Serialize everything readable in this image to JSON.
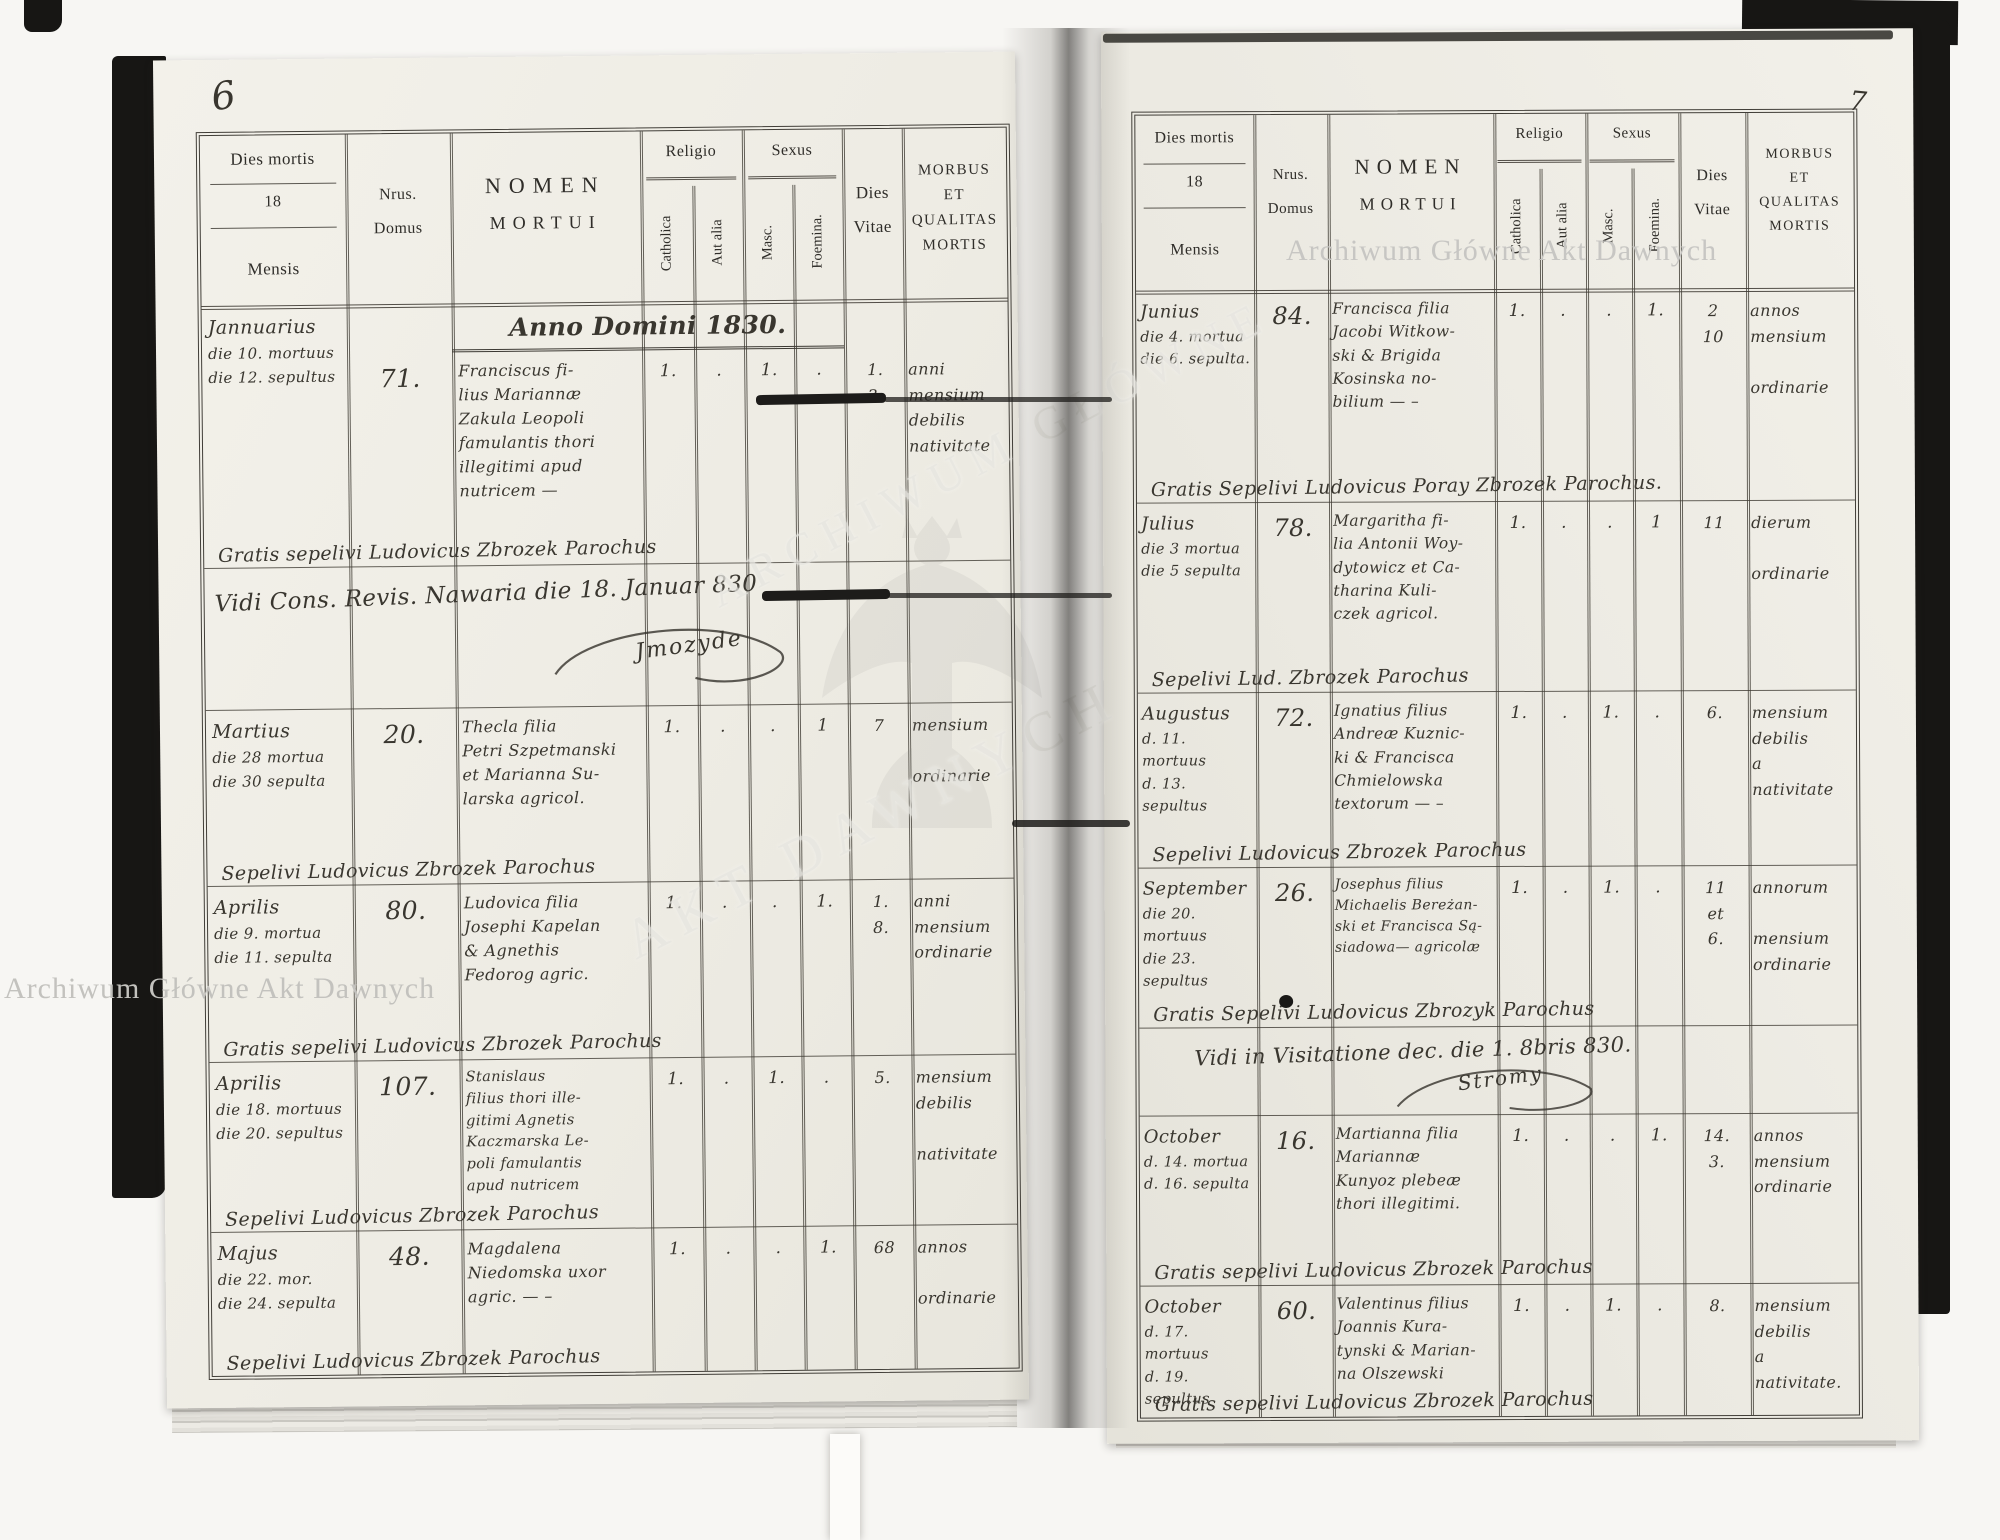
{
  "watermarks": {
    "archive_top": "Archiwum Główne Akt Dawnych",
    "archive_bottom": "Archiwum Główne Akt Dawnych",
    "ghost_line1": "ARCHIWUM GŁÓWNE",
    "ghost_line2": "AKT DAWNYCH"
  },
  "header": {
    "dies_mortis": "Dies mortis",
    "year_prefix": "18",
    "mensis": "Mensis",
    "nrus": "Nrus.",
    "domus": "Domus",
    "nomen": "NOMEN",
    "mortui": "MORTUI",
    "religio": "Religio",
    "catholica": "Catholica",
    "aut_alia": "Aut alia",
    "sexus": "Sexus",
    "masc": "Masc.",
    "foemina": "Foemina.",
    "dies": "Dies",
    "vitae": "Vitae",
    "morbus": "MORBUS",
    "et": "ET",
    "qualitas": "QUALITAS",
    "mortis": "MORTIS"
  },
  "pages": {
    "left": {
      "number": "6",
      "anno_line": "Anno Domini 1830.",
      "visitation": {
        "line": "Vidi Cons. Revis. Nawaria die 18. Januar 830",
        "signature": "Jmozyde"
      },
      "rows": [
        {
          "date": "Jannuarius\ndie 10. mortuus\ndie 12. sepultus",
          "house": "71.",
          "name": "Franciscus fi-\nlius Mariannæ\nZakula Leopoli\nfamulantis thori\nillegitimi apud\nnutricem —",
          "catholica": "1.",
          "aut_alia": ".",
          "masc": "1.",
          "foemina": ".",
          "vitae": "1.\n3.",
          "morbus": "anni\nmensium\ndebilis\nnativitate",
          "footer": "Gratis sepelivi Ludovicus Zbrozek Parochus"
        },
        {
          "date": "Martius\ndie 28 mortua\ndie 30 sepulta",
          "house": "20.",
          "name": "Thecla filia\nPetri Szpetmanski\net Marianna Su-\nlarska agricol.",
          "catholica": "1.",
          "aut_alia": ".",
          "masc": ".",
          "foemina": "1",
          "vitae": "7",
          "morbus": "mensium\n\nordinarie",
          "footer": "Sepelivi Ludovicus Zbrozek Parochus"
        },
        {
          "date": "Aprilis\ndie 9. mortua\ndie 11. sepulta",
          "house": "80.",
          "name": "Ludovica filia\nJosephi Kapelan\n& Agnethis\nFedorog agric.",
          "catholica": "1.",
          "aut_alia": ".",
          "masc": ".",
          "foemina": "1.",
          "vitae": "1.\n8.",
          "morbus": "anni\nmensium\nordinarie",
          "footer": "Gratis sepelivi Ludovicus Zbrozek Parochus"
        },
        {
          "date": "Aprilis\ndie 18. mortuus\ndie 20. sepultus",
          "house": "107.",
          "name": "Stanislaus\nfilius thori ille-\ngitimi Agnetis\nKaczmarska Le-\npoli famulantis\napud nutricem",
          "catholica": "1.",
          "aut_alia": ".",
          "masc": "1.",
          "foemina": ".",
          "vitae": "5.",
          "morbus": "mensium\ndebilis\n\nnativitate",
          "footer": "Sepelivi Ludovicus Zbrozek Parochus"
        },
        {
          "date": "Majus\ndie 22. mor.\ndie 24. sepulta",
          "house": "48.",
          "name": "Magdalena\nNiedomska uxor\nagric. — –",
          "catholica": "1.",
          "aut_alia": ".",
          "masc": ".",
          "foemina": "1.",
          "vitae": "68",
          "morbus": "annos\n\nordinarie",
          "footer": "Sepelivi Ludovicus Zbrozek Parochus"
        }
      ]
    },
    "right": {
      "number": "7",
      "visitation": {
        "line": "Vidi in Visitatione dec. die 1. 8bris 830.",
        "signature": "Stromy"
      },
      "rows": [
        {
          "date": "Junius\ndie 4. mortua\ndie 6. sepulta.",
          "house": "84.",
          "name": "Francisca filia\nJacobi Witkow-\nski & Brigida\nKosinska no-\nbilium — –",
          "catholica": "1.",
          "aut_alia": ".",
          "masc": ".",
          "foemina": "1.",
          "vitae": "2\n10",
          "morbus": "annos\nmensium\n\nordinarie",
          "footer": "Gratis Sepelivi Ludovicus Poray Zbrozek Parochus."
        },
        {
          "date": "Julius\ndie 3 mortua\ndie 5 sepulta",
          "house": "78.",
          "name": "Margaritha fi-\nlia Antonii Woy-\ndytowicz et Ca-\ntharina Kuli-\nczek agricol.",
          "catholica": "1.",
          "aut_alia": ".",
          "masc": ".",
          "foemina": "1",
          "vitae": "11",
          "morbus": "dierum\n\nordinarie",
          "footer": "Sepelivi Lud. Zbrozek Parochus"
        },
        {
          "date": "Augustus\nd. 11. mortuus\nd. 13. sepultus",
          "house": "72.",
          "name": "Ignatius filius\nAndreæ Kuznic-\nki & Francisca\nChmielowska\ntextorum — –",
          "catholica": "1.",
          "aut_alia": ".",
          "masc": "1.",
          "foemina": ".",
          "vitae": "6.",
          "morbus": "mensium\ndebilis\na\nnativitate",
          "footer": "Sepelivi Ludovicus Zbrozek Parochus"
        },
        {
          "date": "September\ndie 20. mortuus\ndie 23. sepultus",
          "house": "26.",
          "name": "Josephus filius\nMichaelis Bereżan-\nski et Francisca Są-\nsiadowa— agricolæ",
          "catholica": "1.",
          "aut_alia": ".",
          "masc": "1.",
          "foemina": ".",
          "vitae": "11\net\n6.",
          "morbus": "annorum\n\nmensium\nordinarie",
          "footer": "Gratis Sepelivi Ludovicus Zbrozyk Parochus"
        },
        {
          "date": "October\nd. 14. mortua\nd. 16. sepulta",
          "house": "16.",
          "name": "Martianna filia\nMariannæ\nKunyoz plebeæ\nthori illegitimi.",
          "catholica": "1.",
          "aut_alia": ".",
          "masc": ".",
          "foemina": "1.",
          "vitae": "14.\n3.",
          "morbus": "annos\nmensium\nordinarie",
          "footer": "Gratis sepelivi Ludovicus Zbrozek Parochus"
        },
        {
          "date": "October\nd. 17. mortuus\nd. 19. sepultus",
          "house": "60.",
          "name": "Valentinus filius\nJoannis Kura-\ntynski & Marian-\nna Olszewski",
          "catholica": "1.",
          "aut_alia": ".",
          "masc": "1.",
          "foemina": ".",
          "vitae": "8.",
          "morbus": "mensium\ndebilis\na\nnativitate.",
          "footer": "Gratis sepelivi Ludovicus Zbrozek Parochus"
        }
      ]
    }
  }
}
